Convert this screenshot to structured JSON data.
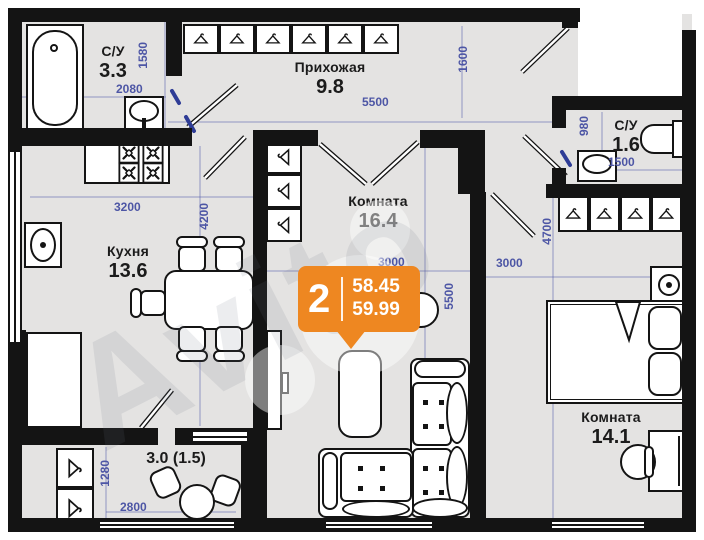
{
  "plan_title": "2-room apartment floor plan",
  "badge": {
    "rooms_count": "2",
    "area_top": "58.45",
    "area_bottom": "59.99",
    "color": "#ee8721"
  },
  "watermark": {
    "text": "Avito"
  },
  "rooms": {
    "bath1": {
      "name": "С/У",
      "area": "3.3"
    },
    "hallway": {
      "name": "Прихожая",
      "area": "9.8"
    },
    "bath2": {
      "name": "С/У",
      "area": "1.6"
    },
    "kitchen": {
      "name": "Кухня",
      "area": "13.6"
    },
    "living": {
      "name": "Комната",
      "area": "16.4"
    },
    "bedroom": {
      "name": "Комната",
      "area": "14.1"
    },
    "balcony": {
      "area": "3.0 (1.5)"
    }
  },
  "dimensions_mm": {
    "bath1_height": "1580",
    "bath1_width": "2080",
    "hallway_width": "5500",
    "hallway_height": "1600",
    "bath2_height": "980",
    "bath2_width": "1500",
    "kitchen_width": "3200",
    "kitchen_height": "4200",
    "living_width": "3000",
    "living_height": "5500",
    "bedroom_width": "3000",
    "bedroom_height": "4700",
    "balcony_height": "1280",
    "balcony_width": "2800"
  },
  "colors": {
    "floor": "#e4e3e2",
    "wall": "#141414",
    "dimension_text": "#4d56a5",
    "badge_orange": "#ee8721"
  }
}
